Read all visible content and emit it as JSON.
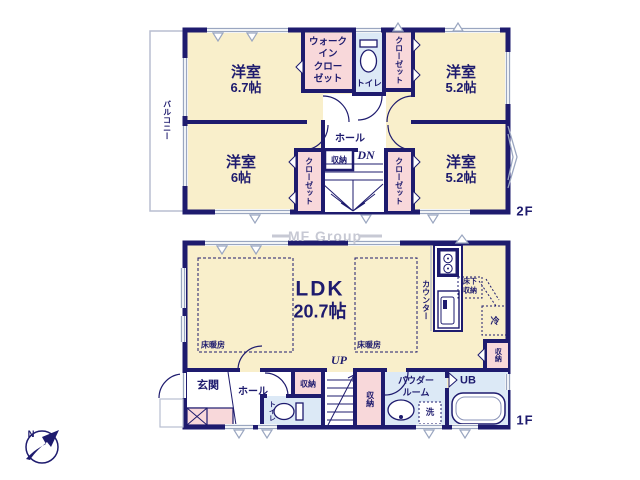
{
  "watermark": {
    "text": "MF Group"
  },
  "compass": {
    "north_label": "N"
  },
  "colors": {
    "wall": "#1e1b6e",
    "room_cream": "#f9efcb",
    "closet_pink": "#f8d8da",
    "wet_blue": "#dce9f6",
    "window_gray": "#9aa6c0",
    "watermark_gray": "#c7c9d4"
  },
  "floor2": {
    "floor_label": "2F",
    "balcony_label": "バルコニー",
    "bedroom_top_left": {
      "name": "洋室",
      "size": "6.7帖"
    },
    "walk_in_closet": {
      "line1": "ウォーク",
      "line2": "イン",
      "line3": "クロー",
      "line4": "ゼット"
    },
    "toilet_label": "トイレ",
    "closet_top_right": "クローゼット",
    "bedroom_top_right": {
      "name": "洋室",
      "size": "5.2帖"
    },
    "hall_label": "ホール",
    "down_label": "DN",
    "storage_label": "収納",
    "closet_bottom_left": "クローゼット",
    "closet_bottom_right": "クローゼット",
    "bedroom_bottom_left": {
      "name": "洋室",
      "size": "6帖"
    },
    "bedroom_bottom_right": {
      "name": "洋室",
      "size": "5.2帖"
    }
  },
  "floor1": {
    "floor_label": "1F",
    "ldk": {
      "name": "LDK",
      "size": "20.7帖"
    },
    "floor_heating_left": "床暖房",
    "floor_heating_right": "床暖房",
    "counter_label": "カウンター",
    "underfloor_storage": {
      "line1": "床下",
      "line2": "収納"
    },
    "fridge_label": "冷",
    "storage_kitchen": "収納",
    "entrance_label": "玄関",
    "hall_label": "ホール",
    "toilet_label": "トイレ",
    "storage_hall": "収納",
    "up_label": "UP",
    "storage_corridor": "収納",
    "powder_room": {
      "line1": "パウダー",
      "line2": "ルーム"
    },
    "washer_label": "洗",
    "bath_label": "UB"
  }
}
